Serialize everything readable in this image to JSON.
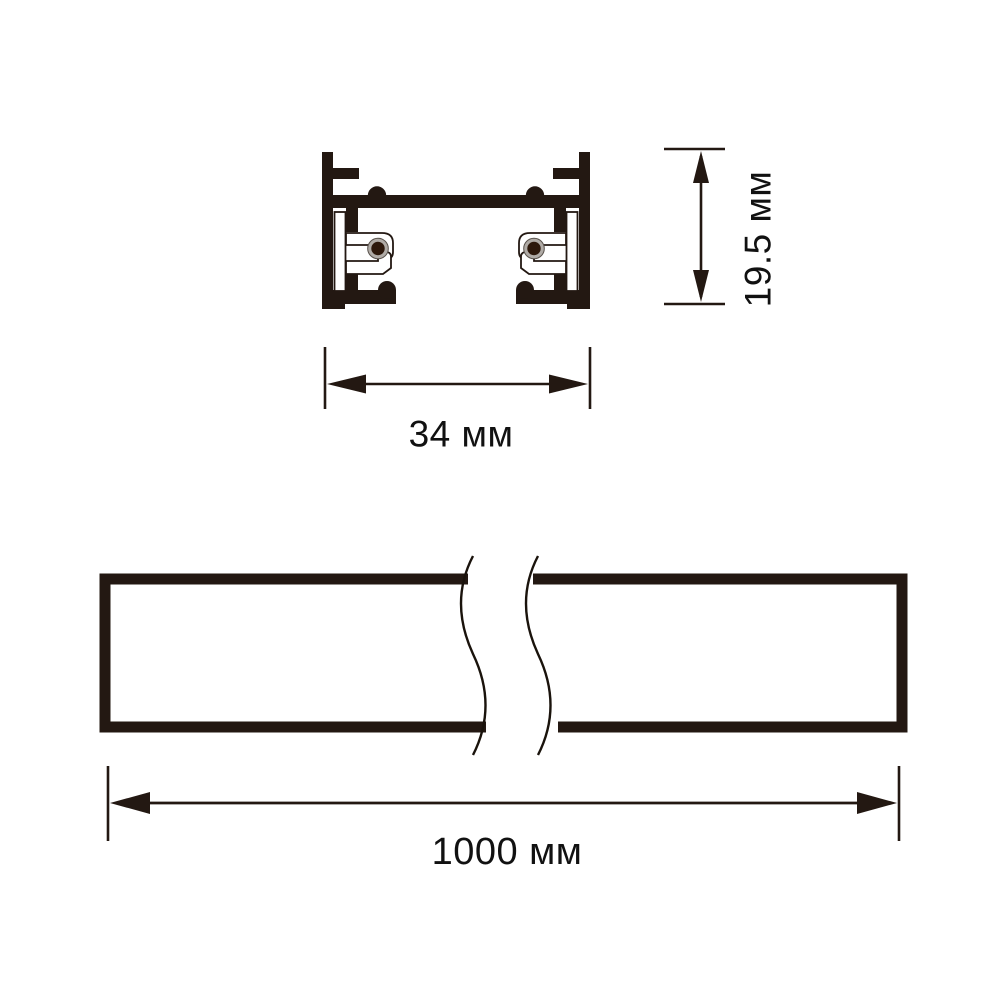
{
  "drawing": {
    "cross_section": {
      "height_dimension": {
        "label": "19.5 мм",
        "value": 19.5,
        "unit": "мм"
      },
      "width_dimension": {
        "label": "34 мм",
        "value": 34,
        "unit": "мм"
      }
    },
    "length_view": {
      "length_dimension": {
        "label": "1000 мм",
        "value": 1000,
        "unit": "мм"
      }
    },
    "colors": {
      "ink": "#231812",
      "text": "#111111",
      "conductor_ring": "#b0aba6",
      "conductor_core": "#2d180b",
      "background": "#ffffff"
    }
  }
}
